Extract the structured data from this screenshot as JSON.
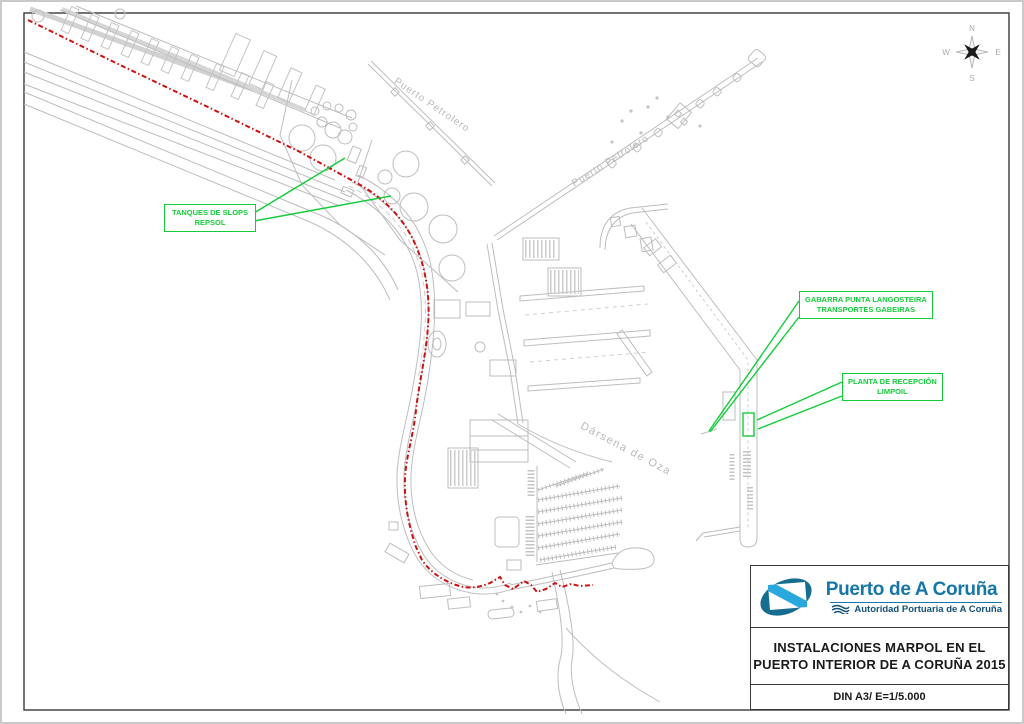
{
  "map": {
    "labels": [
      {
        "text": "Puerto Petrolero"
      },
      {
        "text": "Puerto Petrolero"
      },
      {
        "text": "Dársena de Oza"
      }
    ],
    "annotations": [
      {
        "line1": "TANQUES DE SLOPS",
        "line2": "REPSOL"
      },
      {
        "line1": "GABARRA PUNTA LANGOSTEIRA",
        "line2": "TRANSPORTES GABEIRAS"
      },
      {
        "line1": "PLANTA DE RECEPCIÓN",
        "line2": "LIMPOIL"
      }
    ]
  },
  "compass": {
    "n": "N",
    "s": "S",
    "e": "E",
    "w": "W"
  },
  "title_block": {
    "logo_title": "Puerto de A Coruña",
    "logo_subtitle": "Autoridad Portuaria de A Coruña",
    "title_line1": "INSTALACIONES MARPOL EN EL",
    "title_line2": "PUERTO INTERIOR DE A CORUÑA 2015",
    "scale": "DIN A3/ E=1/5.000"
  },
  "colors": {
    "map_gray": "#bdbdbd",
    "route_red": "#cb1212",
    "annotation_green": "#12cd3a",
    "logo_teal": "#176d90",
    "logo_lightblue": "#2aa7dd",
    "logo_text_blue": "#1577a8",
    "logo_subtext_blue": "#134f77",
    "frame_dark": "#3a3a3a"
  }
}
